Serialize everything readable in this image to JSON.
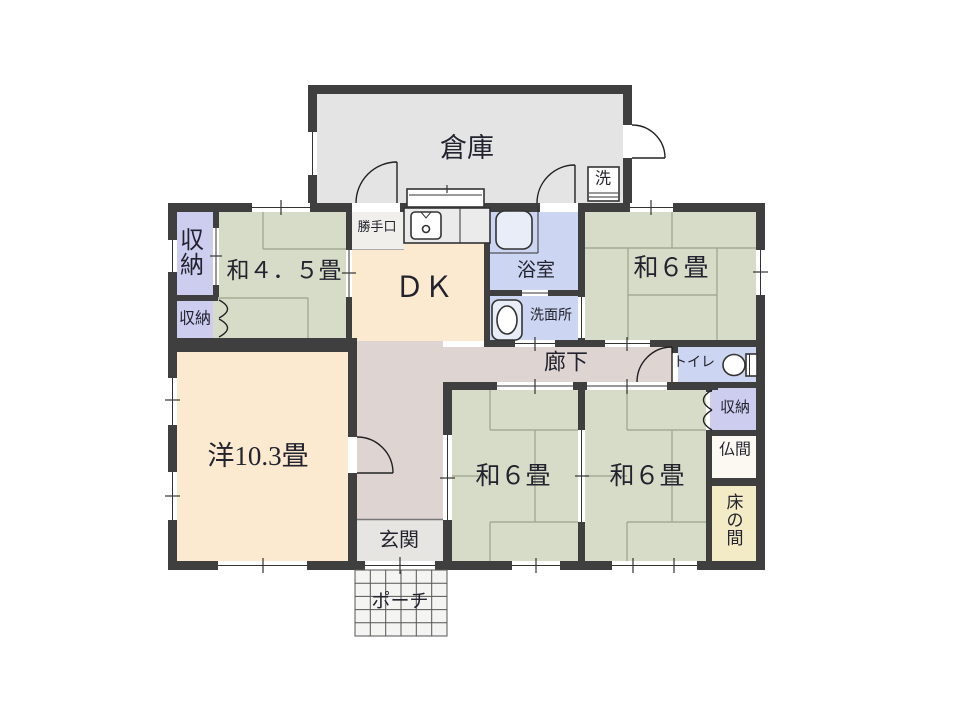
{
  "floorplan": {
    "rooms": {
      "warehouse": "倉庫",
      "closet_upper_left": "収納",
      "closet_lower_left": "収納",
      "washitsu_4_5": "和４．５畳",
      "back_door": "勝手口",
      "dining_kitchen": "ＤＫ",
      "bathroom": "浴室",
      "washroom": "洗面所",
      "laundry": "洗",
      "washitsu_6_ne": "和６畳",
      "corridor": "廊下",
      "toilet": "トイレ",
      "closet_right": "収納",
      "butsuma": "仏間",
      "tokonoma": "床の間",
      "western_room": "洋10.3畳",
      "washitsu_6_sw": "和６畳",
      "washitsu_6_se": "和６畳",
      "entrance": "玄関",
      "porch": "ポーチ"
    },
    "colors": {
      "wall": "#3f3f3f",
      "tatami_green": "#d7dcc8",
      "cream": "#fbe9d0",
      "corridor_pink": "#ded4d2",
      "water_blue": "#ccd5f1",
      "closet_purple": "#cdcdef",
      "warehouse_gray": "#e4e4e4",
      "tokonoma_yellow": "#f2ebc5",
      "genkan_gray": "#e7e5e2",
      "butsuma_white": "#fbf9f2",
      "vestibule_gray": "#f0efec",
      "porch_gray": "#f4f4f3"
    }
  }
}
